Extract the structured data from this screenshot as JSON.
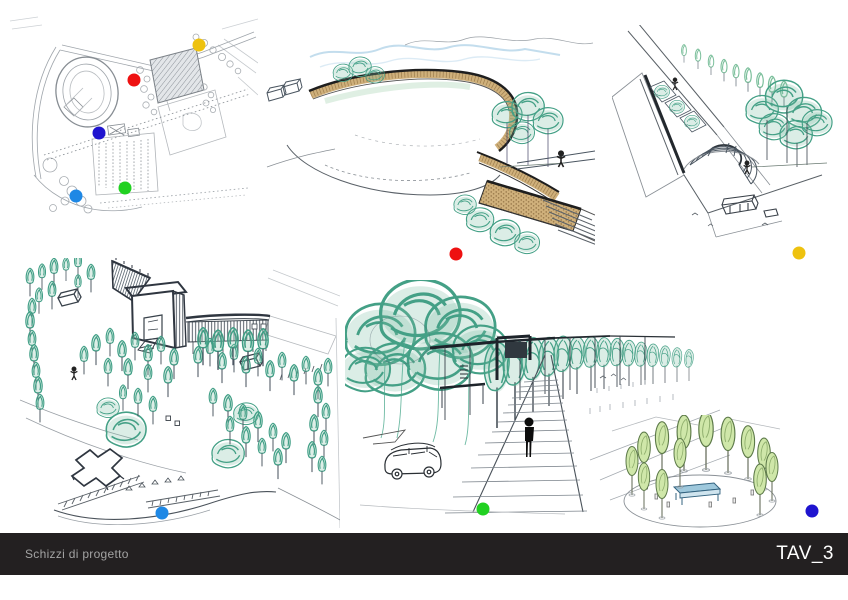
{
  "board": {
    "background_color": "#ffffff",
    "width_px": 848,
    "height_px": 600
  },
  "footer": {
    "caption": "Schizzi di progetto",
    "sheet_number": "TAV_3",
    "bar_color": "#232021",
    "caption_color": "#a3a3a3",
    "sheet_color": "#ffffff"
  },
  "legend_dots": {
    "diameter_px": 13,
    "plan_markers": [
      {
        "key": "plan-yellow",
        "color": "#eec20f",
        "x": 199,
        "y": 45
      },
      {
        "key": "plan-red",
        "color": "#ee1111",
        "x": 134,
        "y": 80
      },
      {
        "key": "plan-blue",
        "color": "#1f14cf",
        "x": 99,
        "y": 133
      },
      {
        "key": "plan-green",
        "color": "#21d121",
        "x": 125,
        "y": 188
      },
      {
        "key": "plan-azure",
        "color": "#1e88e5",
        "x": 76,
        "y": 196
      }
    ],
    "sketch_markers": [
      {
        "key": "sketch-red",
        "color": "#ee1111",
        "x": 456,
        "y": 254
      },
      {
        "key": "sketch-yellow",
        "color": "#eec20f",
        "x": 799,
        "y": 253
      },
      {
        "key": "sketch-azure",
        "color": "#1e88e5",
        "x": 162,
        "y": 513
      },
      {
        "key": "sketch-green",
        "color": "#21d121",
        "x": 483,
        "y": 509
      },
      {
        "key": "sketch-blue",
        "color": "#1f14cf",
        "x": 812,
        "y": 511
      }
    ]
  }
}
